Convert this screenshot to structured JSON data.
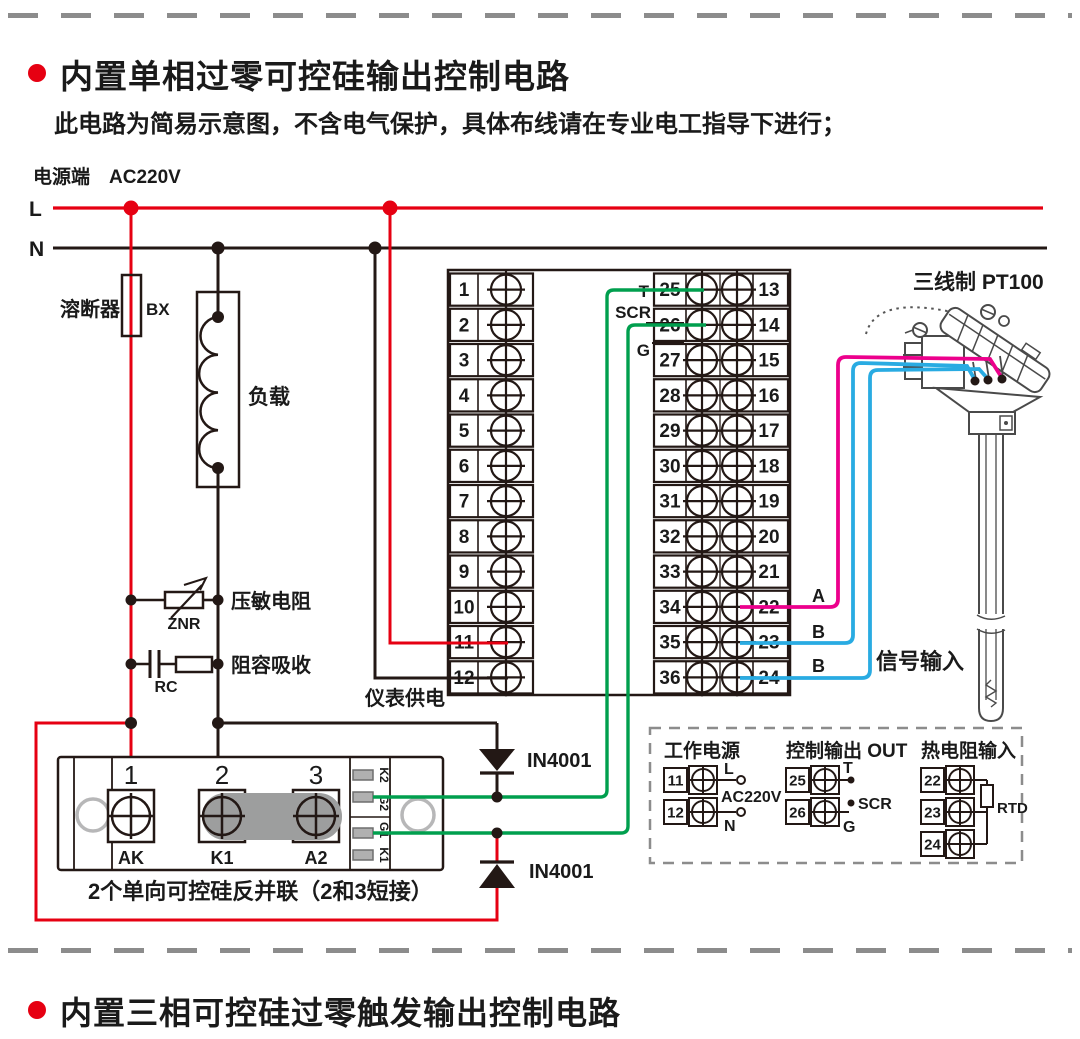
{
  "header": {
    "title": "内置单相过零可控硅输出控制电路",
    "note": "此电路为简易示意图，不含电气保护，具体布线请在专业电工指导下进行；"
  },
  "footer": {
    "title": "内置三相可控硅过零触发输出控制电路"
  },
  "power": {
    "source_label": "电源端　AC220V",
    "l": "L",
    "n": "N"
  },
  "components": {
    "fuse_label": "溶断器",
    "fuse_code": "BX",
    "load_label": "负载",
    "varistor_label": "压敏电阻",
    "varistor_code": "ZNR",
    "snubber_label": "阻容吸收",
    "snubber_code": "RC",
    "meter_supply_label": "仪表供电",
    "diode1_label": "IN4001",
    "diode2_label": "IN4001",
    "scr_module": {
      "terminal_numbers": [
        "1",
        "2",
        "3"
      ],
      "terminal_labels": [
        "AK",
        "K1",
        "A2"
      ],
      "pin_labels": [
        "K2",
        "G2",
        "G1",
        "K1"
      ],
      "caption": "2个单向可控硅反并联（2和3短接）"
    }
  },
  "instrument": {
    "left_terminals": [
      "1",
      "2",
      "3",
      "4",
      "5",
      "6",
      "7",
      "8",
      "9",
      "10",
      "11",
      "12"
    ],
    "mid_terminals": [
      "25",
      "26",
      "27",
      "28",
      "29",
      "30",
      "31",
      "32",
      "33",
      "34",
      "35",
      "36"
    ],
    "right_terminals": [
      "13",
      "14",
      "15",
      "16",
      "17",
      "18",
      "19",
      "20",
      "21",
      "22",
      "23",
      "24"
    ],
    "output_labels": {
      "t": "T",
      "scr": "SCR",
      "g": "G"
    }
  },
  "sensor": {
    "title": "三线制  PT100",
    "wire_labels": [
      "A",
      "B",
      "B"
    ],
    "signal_label": "信号输入"
  },
  "legend": {
    "power": {
      "title": "工作电源",
      "terminals": [
        "11",
        "12"
      ],
      "l": "L",
      "n": "N",
      "voltage": "AC220V"
    },
    "output": {
      "title": "控制输出 OUT",
      "terminals": [
        "25",
        "26"
      ],
      "t": "T",
      "scr": "SCR",
      "g": "G"
    },
    "rtd": {
      "title": "热电阻输入",
      "terminals": [
        "22",
        "23",
        "24"
      ],
      "label": "RTD"
    }
  },
  "colors": {
    "line_red": "#e60012",
    "line_black": "#231815",
    "wire_green": "#009f4e",
    "wire_magenta": "#ec008c",
    "wire_cyan": "#29abe2",
    "dash_gray": "#8c8c8c",
    "short_bar_gray": "#9d9e9e"
  }
}
